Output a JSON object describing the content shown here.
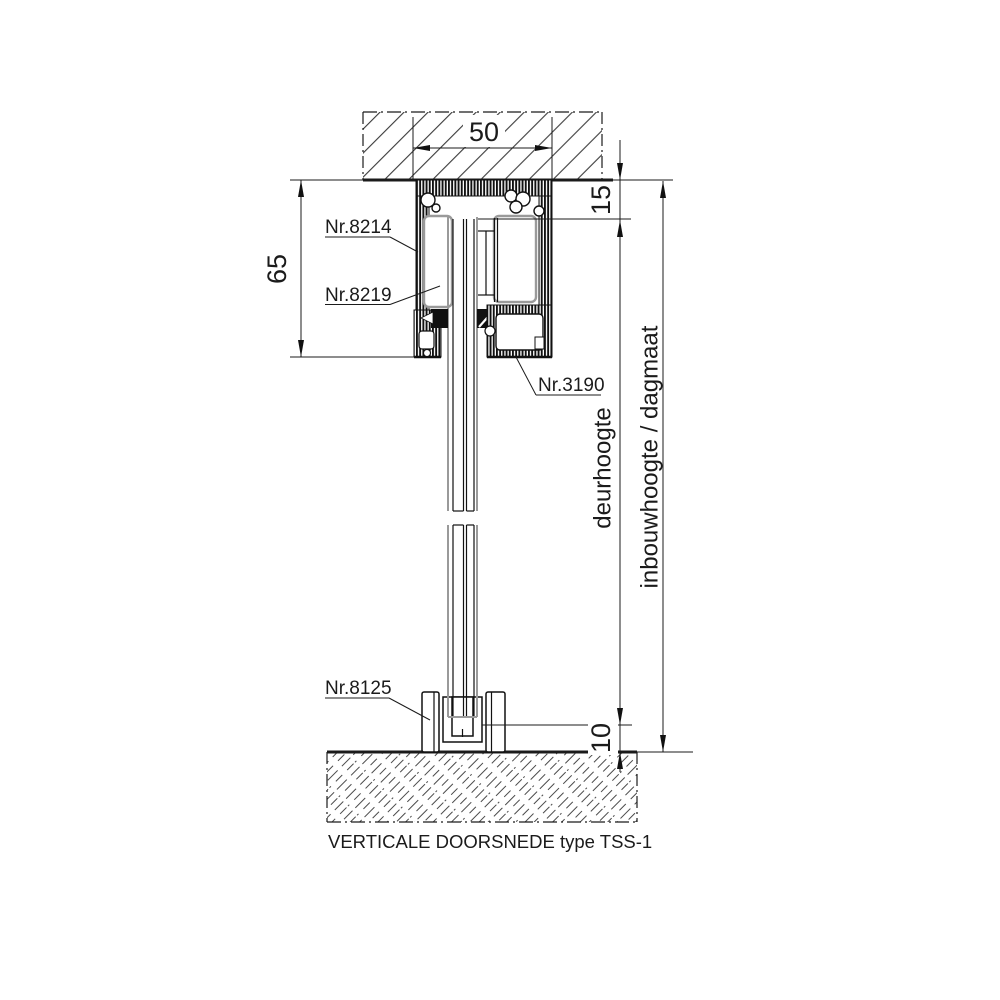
{
  "diagram": {
    "caption": "VERTICALE DOORSNEDE type TSS-1",
    "dimensions": {
      "track_width": "50",
      "track_height": "65",
      "top_clearance": "15",
      "bottom_clearance": "10",
      "door_height_label": "deurhoogte",
      "installation_height_label": "inbouwhoogte / dagmaat"
    },
    "parts": {
      "top_track_profile": "Nr.8214",
      "roller_insert": "Nr.8219",
      "bottom_cover_profile": "Nr.3190",
      "floor_guide_profile": "Nr.8125"
    },
    "colors": {
      "line": "#1b1b1b",
      "soft_gray": "#9a9a9a",
      "background": "#ffffff"
    }
  }
}
